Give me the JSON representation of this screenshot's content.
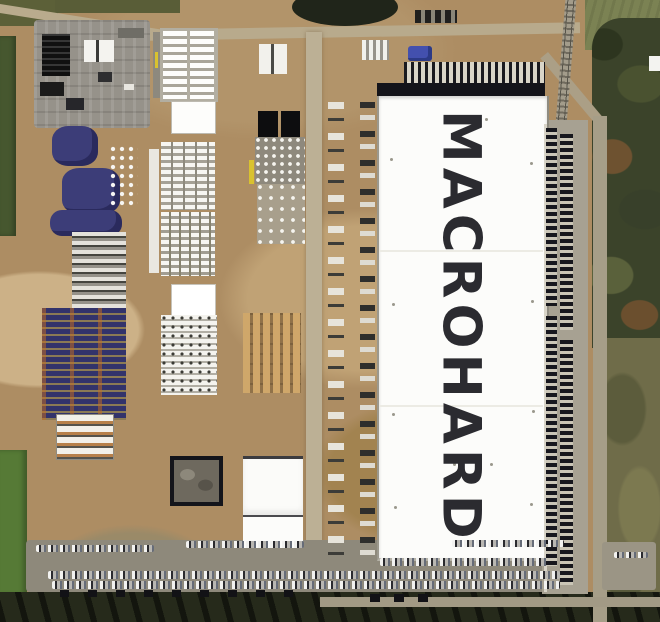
{
  "scene": {
    "type": "satellite aerial photograph",
    "subject": "large construction site with white warehouse and rooftop sign"
  },
  "building": {
    "label": "MACROHARD",
    "label_color": "#2b2b30",
    "roof_color": "#fcfcfa"
  },
  "palette": {
    "dirt": "#ad8d63",
    "gravel_pad": "#96928a",
    "grass_dark": "#46572f",
    "grass_bright": "#567a36",
    "trees": "#3b432a",
    "purple_materials": "#3c3d78",
    "asphalt_lot": "#8e897b",
    "trailer_dark": "#17171d",
    "crane_yellow": "#d9c22f"
  }
}
